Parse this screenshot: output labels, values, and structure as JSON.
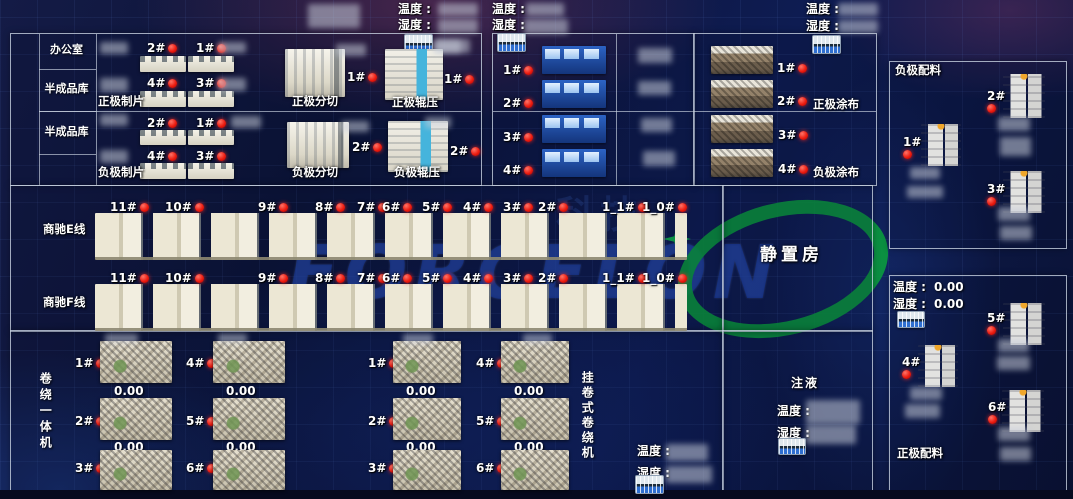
{
  "colors": {
    "status_red": "#e10600",
    "panel_border": "#cdd6e4",
    "watermark_blue": "#163eac",
    "watermark_green": "#0a9e3e"
  },
  "env": {
    "temp_label": "温度 :",
    "hum_label": "湿度 :"
  },
  "panel_a": {
    "rooms": [
      "办公室",
      "半成品库",
      "半成品库"
    ],
    "pos_sheet": {
      "title": "正极制片",
      "machines": [
        "2#",
        "1#",
        "4#",
        "3#"
      ]
    },
    "pos_slit": {
      "title": "正极分切",
      "machine": "1#"
    },
    "pos_press": {
      "title": "正极辊压",
      "machine": "1#"
    },
    "neg_sheet": {
      "title": "负极制片",
      "machines": [
        "2#",
        "1#",
        "4#",
        "3#"
      ]
    },
    "neg_slit": {
      "title": "负极分切",
      "machine": "2#"
    },
    "neg_press": {
      "title": "负极辊压",
      "machine": "2#"
    }
  },
  "coating": {
    "feeders": [
      "1#",
      "2#",
      "3#",
      "4#"
    ],
    "coaters": [
      "1#",
      "2#",
      "3#",
      "4#"
    ],
    "pos_title": "正极涂布",
    "neg_title": "负极涂布"
  },
  "neg_batching": {
    "title": "负极配料",
    "machines": [
      "2#",
      "1#",
      "3#"
    ]
  },
  "pos_batching": {
    "title": "正极配料",
    "temp_value": "0.00",
    "hum_value": "0.00",
    "machines": [
      "5#",
      "4#",
      "6#"
    ]
  },
  "lines": {
    "e_label": "商驰E线",
    "f_label": "商驰F线",
    "stations": [
      "11#",
      "10#",
      "9#",
      "8#",
      "7#",
      "6#",
      "5#",
      "4#",
      "3#",
      "2#",
      "1_1#",
      "1_0#"
    ]
  },
  "rest_room_label": "静置房",
  "winding": {
    "label": "卷绕一体机",
    "col1": [
      {
        "no": "1#",
        "value": "0.00"
      },
      {
        "no": "2#",
        "value": "0.00"
      },
      {
        "no": "3#"
      }
    ],
    "col2": [
      {
        "no": "4#",
        "value": "0.00"
      },
      {
        "no": "5#",
        "value": "0.00"
      },
      {
        "no": "6#"
      }
    ]
  },
  "hanging_winder": {
    "label": "挂卷式卷绕机",
    "col1": [
      {
        "no": "1#",
        "value": "0.00"
      },
      {
        "no": "2#",
        "value": "0.00"
      },
      {
        "no": "3#"
      }
    ],
    "col2": [
      {
        "no": "4#",
        "value": "0.00"
      },
      {
        "no": "5#",
        "value": "0.00"
      },
      {
        "no": "6#"
      }
    ]
  },
  "injection": {
    "title": "注液"
  },
  "watermark": {
    "text": "FORCELON",
    "cn_text": "科技"
  }
}
